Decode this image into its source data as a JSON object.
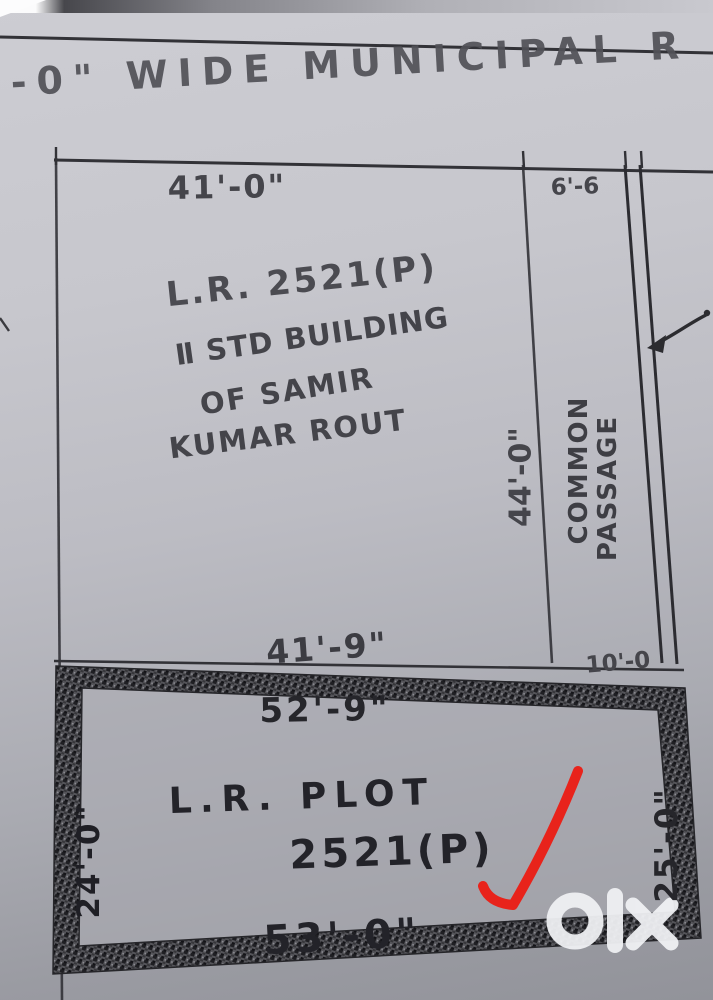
{
  "road": {
    "label": "'-0\" WIDE MUNICIPAL R"
  },
  "top_plot": {
    "dim_top": "41'-0\"",
    "dim_bottom": "41'-9\"",
    "dim_right": "44'-0\"",
    "id_label": "L.R. 2521(P)",
    "building_line1": "Ⅱ STD BUILDING",
    "building_line2": "OF SAMIR",
    "building_line3": "KUMAR ROUT"
  },
  "passage": {
    "dim_top": "6'-6",
    "dim_bottom": "10'-0",
    "name_line1": "COMMON",
    "name_line2": "PASSAGE"
  },
  "lower_plot": {
    "dim_top": "52'-9\"",
    "dim_bottom": "53'-0\"",
    "dim_left": "24'-0\"",
    "dim_right": "25'-0\"",
    "name_line1": "L.R. PLOT",
    "name_line2": "2521(P)"
  },
  "watermark": {
    "brand": "olx"
  },
  "colors": {
    "ink": "#3a3a3f",
    "heavy_ink": "#202024",
    "checkmark_red": "#e8231b",
    "paper_light": "#cbcbd1",
    "paper_dark": "#96979e",
    "watermark_white": "#f0f1f4"
  }
}
